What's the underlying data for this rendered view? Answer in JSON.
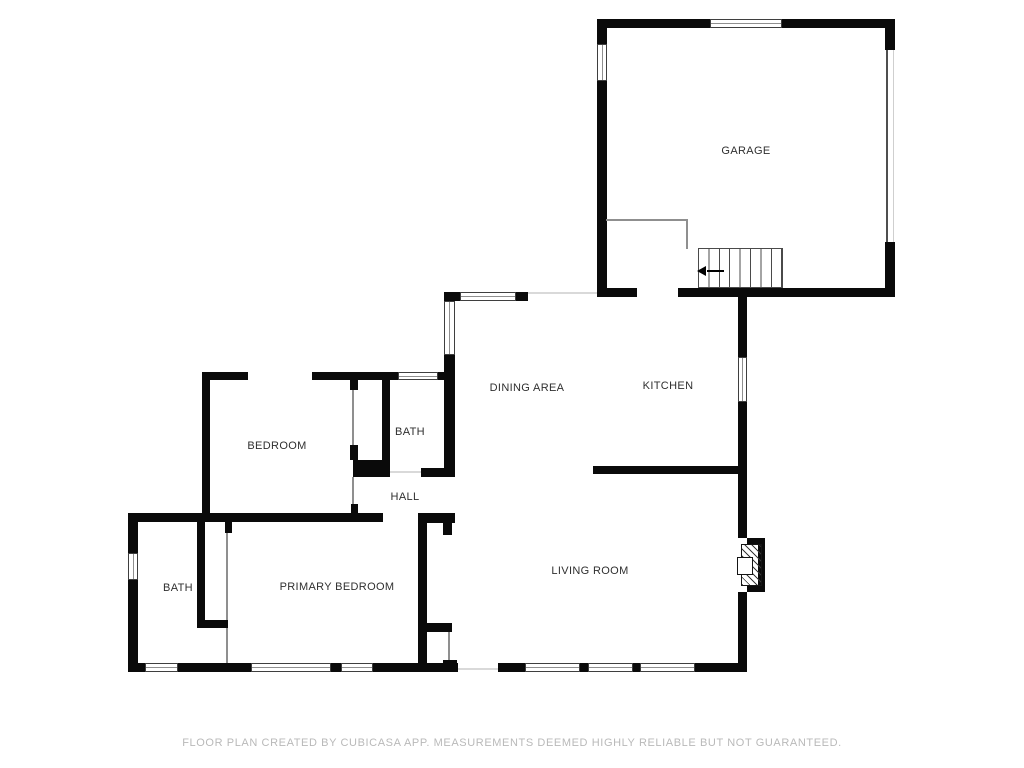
{
  "rooms": {
    "garage": "GARAGE",
    "dining_area": "DINING AREA",
    "kitchen": "KITCHEN",
    "bedroom": "BEDROOM",
    "bath_upper": "BATH",
    "hall": "HALL",
    "bath_lower": "BATH",
    "primary_bedroom": "PRIMARY BEDROOM",
    "living_room": "LIVING ROOM"
  },
  "footer": {
    "disclaimer": "FLOOR PLAN CREATED BY CUBICASA APP. MEASUREMENTS DEEMED HIGHLY RELIABLE BUT NOT GUARANTEED."
  },
  "colors": {
    "wall": "#0a0a0a",
    "background": "#ffffff",
    "label_text": "#2f2f2f",
    "footer_text": "#b9b9b9",
    "thin_line": "#8f8f8f"
  }
}
